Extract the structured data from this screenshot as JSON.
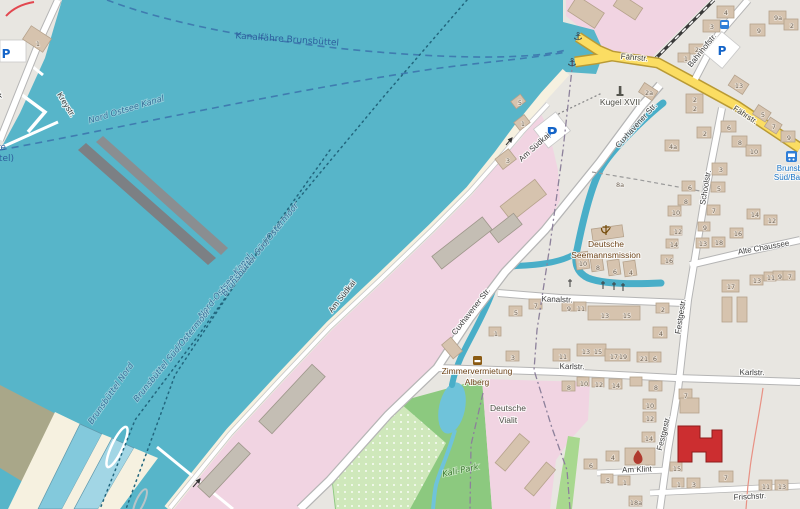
{
  "streets": {
    "kreystr": "Kreystr.",
    "faehrstr": "Fährstr.",
    "bahnhofstr": "Bahnhofstr.",
    "schoolstr": "Schoolstr.",
    "cuxhavener": "Cuxhavener Str.",
    "am_suedkai": "Am Südkai",
    "kanalstr": "Kanalstr.",
    "karlstr": "Karlstr.",
    "alte_chaussee": "Alte Chaussee",
    "festgestr": "Festgestr.",
    "am_klint": "Am Klint",
    "frischstr": "Frischstr."
  },
  "water": {
    "canal_name": "Nord Ostsee Kanal",
    "ferry_route": "Kanalfähre Brunsbüttel",
    "ferry_fragment_1": "(Kanalfähre",
    "ferry_fragment_2": "Brunsbüttel)",
    "boundary_canal": "Nord-Ostsee-Kanal",
    "boundary_sued": "Brunsbüttel Süd/Ostermoor",
    "boundary_nord": "Brunsbüttel Nord"
  },
  "pois": {
    "kugel": "Kugel XVII",
    "seemannsmission_1": "Deutsche",
    "seemannsmission_2": "Seemannsmission",
    "zimmervermietung_1": "Zimmervermietung",
    "zimmervermietung_2": "Alberg",
    "vialit_1": "Deutsche",
    "vialit_2": "Vialit",
    "kali_park": "Kali-Park",
    "bus_stop_1": "Brunsbüttel",
    "bus_stop_2": "Süd/Bahnhof",
    "parking": "P"
  },
  "housenumbers": [
    "1",
    "4",
    "3",
    "2",
    "1",
    "9a",
    "9",
    "2",
    "2a",
    "2",
    "2",
    "13",
    "5",
    "7",
    "6",
    "8",
    "10",
    "9",
    "2",
    "4a",
    "3",
    "5",
    "6",
    "8",
    "10",
    "8a",
    "1",
    "5",
    "3",
    "10",
    "8",
    "6",
    "4",
    "12",
    "14",
    "16",
    "13",
    "18",
    "7",
    "9",
    "16",
    "14",
    "12",
    "17",
    "13",
    "11",
    "9",
    "7",
    "5",
    "7",
    "9",
    "11",
    "13",
    "15",
    "2",
    "4",
    "1",
    "3",
    "11",
    "13",
    "15",
    "17",
    "19",
    "21",
    "6",
    "8",
    "10",
    "12",
    "14",
    "8",
    "7",
    "10",
    "12",
    "14",
    "4",
    "6",
    "5",
    "1",
    "18a",
    "15",
    "1",
    "3",
    "7",
    "11",
    "13"
  ],
  "colors": {
    "water": "#57b5c9",
    "industrial_pink": "#f1d4e2",
    "road_yellow": "#fbdd62",
    "park_green": "#8cc97f",
    "allotment_green": "#cfe8bb",
    "building_tan": "#d6c3ae",
    "fire_station_red": "#cc2e30",
    "ferry_blue": "#3f7cb0"
  }
}
